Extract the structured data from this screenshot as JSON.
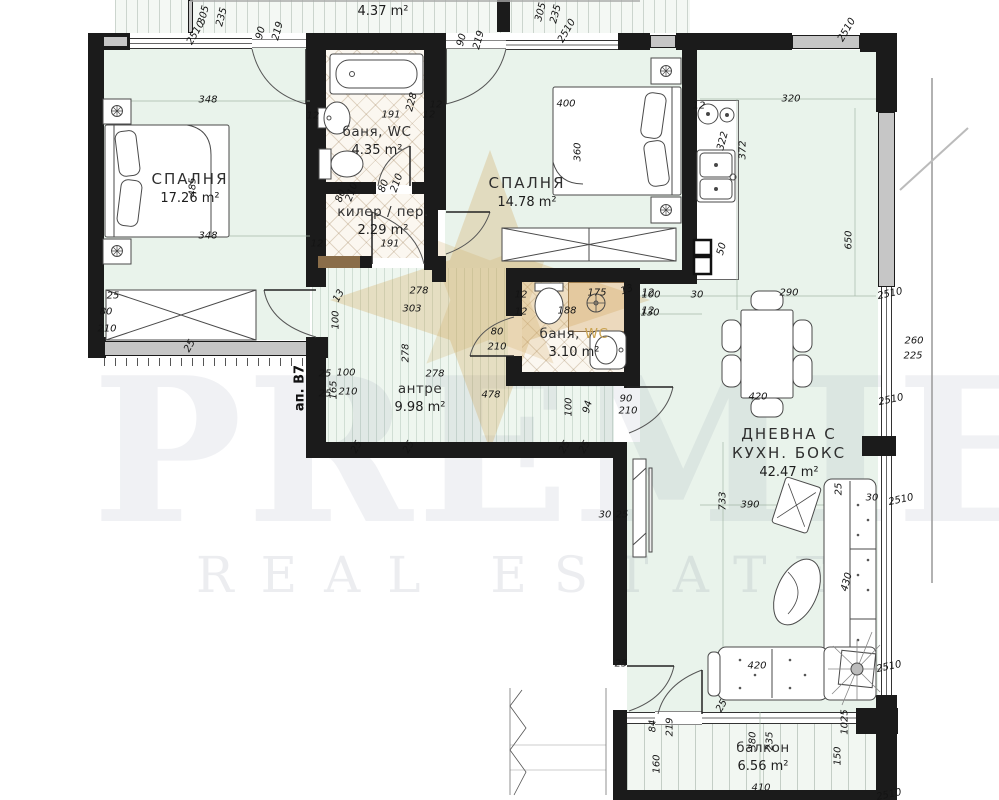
{
  "watermark": {
    "brand": "PREMIER",
    "tagline": "REAL ESTATE"
  },
  "apartment_label": "ап. B7",
  "colors": {
    "wall": "#1b1b1b",
    "floor_mint": "#e9f3eb",
    "bath_cream": "#fbf7f0",
    "wood_partition": "#8a6d49",
    "shower_beige": "#ecd9bd",
    "watermark_gold": "#cfa558",
    "watermark_grey": "#e9e9ee"
  },
  "rooms": [
    {
      "name": "СПАЛНЯ",
      "area": "17.26 m²",
      "x": 190,
      "y": 170,
      "cls": "lg"
    },
    {
      "name": "баня, WC",
      "area": "4.35 m²",
      "x": 377,
      "y": 124,
      "cls": "md"
    },
    {
      "name": "килер / пер.",
      "area": "2.29 m²",
      "x": 383,
      "y": 204,
      "cls": "md"
    },
    {
      "name": "СПАЛНЯ",
      "area": "14.78 m²",
      "x": 527,
      "y": 174,
      "cls": "lg"
    },
    {
      "name": "баня,",
      "gold": "WC",
      "area": "3.10 m²",
      "x": 574,
      "y": 326,
      "cls": "md"
    },
    {
      "name": "антре",
      "area": "9.98 m²",
      "x": 420,
      "y": 381,
      "cls": "md"
    },
    {
      "name": "ДНЕВНА С\nКУХН. БОКС",
      "area": "42.47 m²",
      "x": 789,
      "y": 425,
      "cls": "lg"
    },
    {
      "name": "балкон",
      "area": "6.56 m²",
      "x": 763,
      "y": 740,
      "cls": "md"
    },
    {
      "name": "",
      "area": "4.37 m²",
      "x": 383,
      "y": 2,
      "cls": "md"
    }
  ],
  "dimension_labels": [
    {
      "t": "2510",
      "x": 196,
      "y": 33,
      "r": -60
    },
    {
      "t": "305",
      "x": 204,
      "y": 15,
      "r": -75
    },
    {
      "t": "235",
      "x": 222,
      "y": 17,
      "r": -75
    },
    {
      "t": "90",
      "x": 261,
      "y": 33,
      "r": -75
    },
    {
      "t": "219",
      "x": 278,
      "y": 31,
      "r": -75
    },
    {
      "t": "305",
      "x": 541,
      "y": 12,
      "r": -75
    },
    {
      "t": "235",
      "x": 556,
      "y": 14,
      "r": -75
    },
    {
      "t": "2510",
      "x": 567,
      "y": 31,
      "r": -60
    },
    {
      "t": "90",
      "x": 462,
      "y": 40,
      "r": -75
    },
    {
      "t": "219",
      "x": 479,
      "y": 40,
      "r": -75
    },
    {
      "t": "2510",
      "x": 847,
      "y": 30,
      "r": -60
    },
    {
      "t": "348",
      "x": 208,
      "y": 100
    },
    {
      "t": "348",
      "x": 208,
      "y": 236
    },
    {
      "t": "485",
      "x": 193,
      "y": 187,
      "r": -90
    },
    {
      "t": "25",
      "x": 190,
      "y": 346,
      "r": -60
    },
    {
      "t": "191",
      "x": 391,
      "y": 115
    },
    {
      "t": "228",
      "x": 412,
      "y": 102,
      "r": -75
    },
    {
      "t": "12",
      "x": 313,
      "y": 116
    },
    {
      "t": "12",
      "x": 429,
      "y": 115
    },
    {
      "t": "80",
      "x": 384,
      "y": 186,
      "r": -70
    },
    {
      "t": "210",
      "x": 397,
      "y": 183,
      "r": -70
    },
    {
      "t": "80",
      "x": 341,
      "y": 196,
      "r": -70
    },
    {
      "t": "210",
      "x": 352,
      "y": 192,
      "r": -70
    },
    {
      "t": "191",
      "x": 390,
      "y": 244
    },
    {
      "t": "12",
      "x": 317,
      "y": 244
    },
    {
      "t": "400",
      "x": 566,
      "y": 104
    },
    {
      "t": "360",
      "x": 578,
      "y": 152,
      "r": -90
    },
    {
      "t": "12",
      "x": 436,
      "y": 105
    },
    {
      "t": "12",
      "x": 699,
      "y": 106
    },
    {
      "t": "320",
      "x": 791,
      "y": 99
    },
    {
      "t": "322",
      "x": 723,
      "y": 141,
      "r": -75
    },
    {
      "t": "372",
      "x": 743,
      "y": 150,
      "r": -90
    },
    {
      "t": "50",
      "x": 722,
      "y": 249,
      "r": -75
    },
    {
      "t": "100",
      "x": 651,
      "y": 295
    },
    {
      "t": "30",
      "x": 697,
      "y": 295
    },
    {
      "t": "290",
      "x": 789,
      "y": 293
    },
    {
      "t": "130",
      "x": 650,
      "y": 313
    },
    {
      "t": "650",
      "x": 849,
      "y": 240,
      "r": -90
    },
    {
      "t": "2510",
      "x": 890,
      "y": 294,
      "r": -12
    },
    {
      "t": "260",
      "x": 914,
      "y": 341
    },
    {
      "t": "225",
      "x": 913,
      "y": 356
    },
    {
      "t": "2510",
      "x": 891,
      "y": 400,
      "r": -12
    },
    {
      "t": "30",
      "x": 872,
      "y": 498
    },
    {
      "t": "2510",
      "x": 901,
      "y": 500,
      "r": -12
    },
    {
      "t": "25",
      "x": 839,
      "y": 489,
      "r": -90
    },
    {
      "t": "2510",
      "x": 889,
      "y": 667,
      "r": -12
    },
    {
      "t": "2510",
      "x": 889,
      "y": 795,
      "r": -12
    },
    {
      "t": "175",
      "x": 597,
      "y": 293
    },
    {
      "t": "13",
      "x": 627,
      "y": 290,
      "r": -20
    },
    {
      "t": "188",
      "x": 567,
      "y": 311
    },
    {
      "t": "12",
      "x": 521,
      "y": 295
    },
    {
      "t": "12",
      "x": 521,
      "y": 312
    },
    {
      "t": "12",
      "x": 648,
      "y": 293
    },
    {
      "t": "12",
      "x": 648,
      "y": 311
    },
    {
      "t": "80",
      "x": 497,
      "y": 332
    },
    {
      "t": "210",
      "x": 497,
      "y": 347
    },
    {
      "t": "278",
      "x": 419,
      "y": 291
    },
    {
      "t": "303",
      "x": 412,
      "y": 309
    },
    {
      "t": "100",
      "x": 336,
      "y": 320,
      "r": -90
    },
    {
      "t": "13",
      "x": 339,
      "y": 296,
      "r": -60
    },
    {
      "t": "278",
      "x": 406,
      "y": 353,
      "r": -90
    },
    {
      "t": "278",
      "x": 435,
      "y": 374
    },
    {
      "t": "478",
      "x": 491,
      "y": 395
    },
    {
      "t": "100",
      "x": 569,
      "y": 407,
      "r": -90
    },
    {
      "t": "94",
      "x": 588,
      "y": 407,
      "r": -75
    },
    {
      "t": "90",
      "x": 626,
      "y": 399
    },
    {
      "t": "210",
      "x": 628,
      "y": 411
    },
    {
      "t": "25",
      "x": 113,
      "y": 296
    },
    {
      "t": "80",
      "x": 106,
      "y": 312
    },
    {
      "t": "210",
      "x": 107,
      "y": 329
    },
    {
      "t": "25",
      "x": 325,
      "y": 374
    },
    {
      "t": "100",
      "x": 346,
      "y": 373
    },
    {
      "t": "165",
      "x": 334,
      "y": 390,
      "r": -90
    },
    {
      "t": "25",
      "x": 325,
      "y": 394
    },
    {
      "t": "210",
      "x": 348,
      "y": 392
    },
    {
      "t": "25",
      "x": 357,
      "y": 447,
      "r": -60
    },
    {
      "t": "25",
      "x": 409,
      "y": 447,
      "r": -60
    },
    {
      "t": "25",
      "x": 565,
      "y": 447,
      "r": -60
    },
    {
      "t": "25",
      "x": 585,
      "y": 447,
      "r": -60
    },
    {
      "t": "30",
      "x": 605,
      "y": 515
    },
    {
      "t": "25",
      "x": 622,
      "y": 515
    },
    {
      "t": "25",
      "x": 621,
      "y": 664
    },
    {
      "t": "733",
      "x": 723,
      "y": 501,
      "r": -90
    },
    {
      "t": "390",
      "x": 750,
      "y": 505
    },
    {
      "t": "420",
      "x": 758,
      "y": 397
    },
    {
      "t": "420",
      "x": 757,
      "y": 666
    },
    {
      "t": "430",
      "x": 847,
      "y": 582,
      "r": -75
    },
    {
      "t": "1025",
      "x": 845,
      "y": 722,
      "r": -90
    },
    {
      "t": "84",
      "x": 653,
      "y": 726,
      "r": -90
    },
    {
      "t": "219",
      "x": 670,
      "y": 727,
      "r": -90
    },
    {
      "t": "25",
      "x": 722,
      "y": 706,
      "r": -60
    },
    {
      "t": "380",
      "x": 753,
      "y": 741,
      "r": -90
    },
    {
      "t": "235",
      "x": 770,
      "y": 741,
      "r": -90
    },
    {
      "t": "160",
      "x": 657,
      "y": 764,
      "r": -90
    },
    {
      "t": "150",
      "x": 838,
      "y": 756,
      "r": -90
    },
    {
      "t": "410",
      "x": 761,
      "y": 788
    }
  ]
}
